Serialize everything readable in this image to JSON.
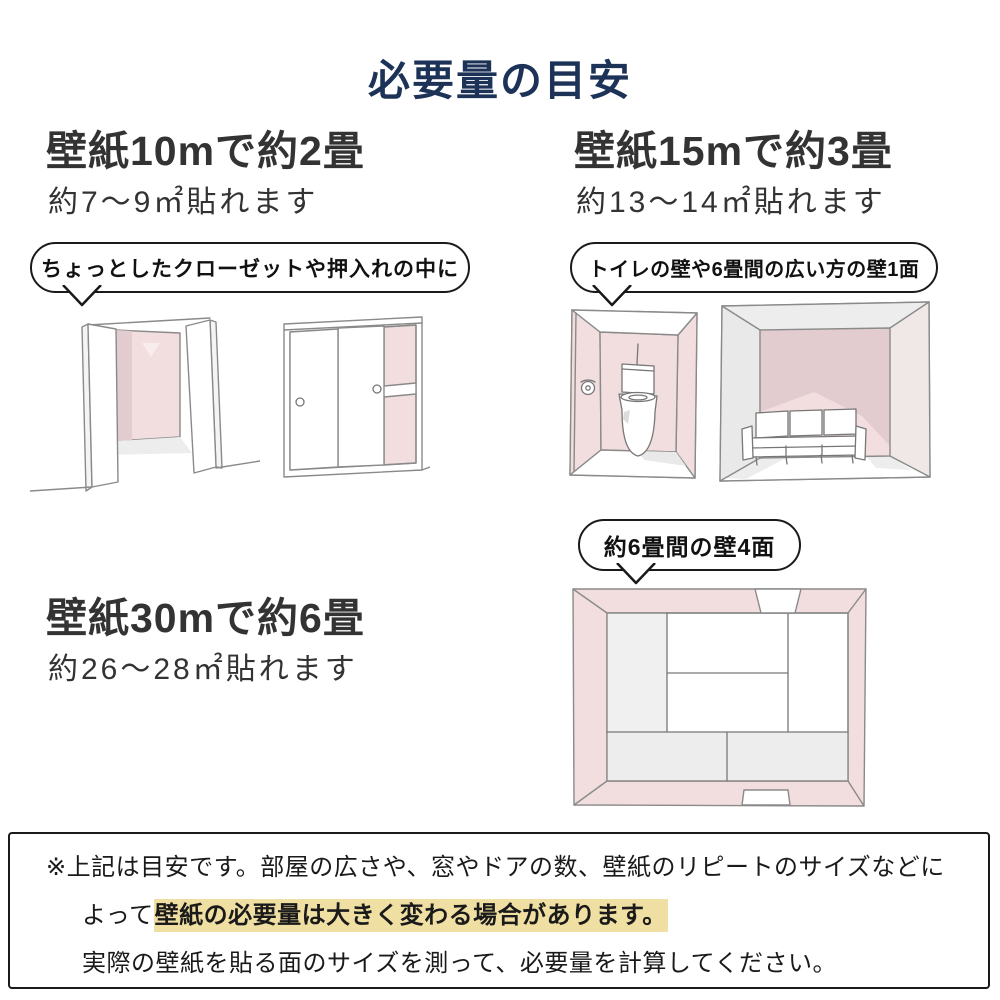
{
  "title": "必要量の目安",
  "sections": [
    {
      "heading": "壁紙10mで約2畳",
      "subtitle": "約7〜9㎡貼れます",
      "bubble": "ちょっとしたクローゼットや押入れの中に"
    },
    {
      "heading": "壁紙15mで約3畳",
      "subtitle": "約13〜14㎡貼れます",
      "bubble": "トイレの壁や6畳間の広い方の壁1面"
    },
    {
      "heading": "壁紙30mで約6畳",
      "subtitle": "約26〜28㎡貼れます",
      "bubble": "約6畳間の壁4面"
    }
  ],
  "note": {
    "line1": "※上記は目安です。部屋の広さや、窓やドアの数、壁紙のリピートのサイズなどに",
    "line2_prefix": "よって",
    "line2_highlight": "壁紙の必要量は大きく変わる場合があります。",
    "line3": "実際の壁紙を貼る面のサイズを測って、必要量を計算してください。"
  },
  "illustrations": [
    "open-closet",
    "sliding-closet",
    "toilet-room",
    "living-room",
    "tatami-room-top-view"
  ],
  "colors": {
    "accent_navy": "#1c3257",
    "heading_text": "#333333",
    "wall_pink": "#f2dede",
    "wall_pink_dark": "#e3ccd0",
    "floor_gray": "#ededed",
    "sketch_line": "#8a8a8a",
    "highlight_yellow": "#f0dfa2",
    "border_dark": "#1a1a1a"
  }
}
